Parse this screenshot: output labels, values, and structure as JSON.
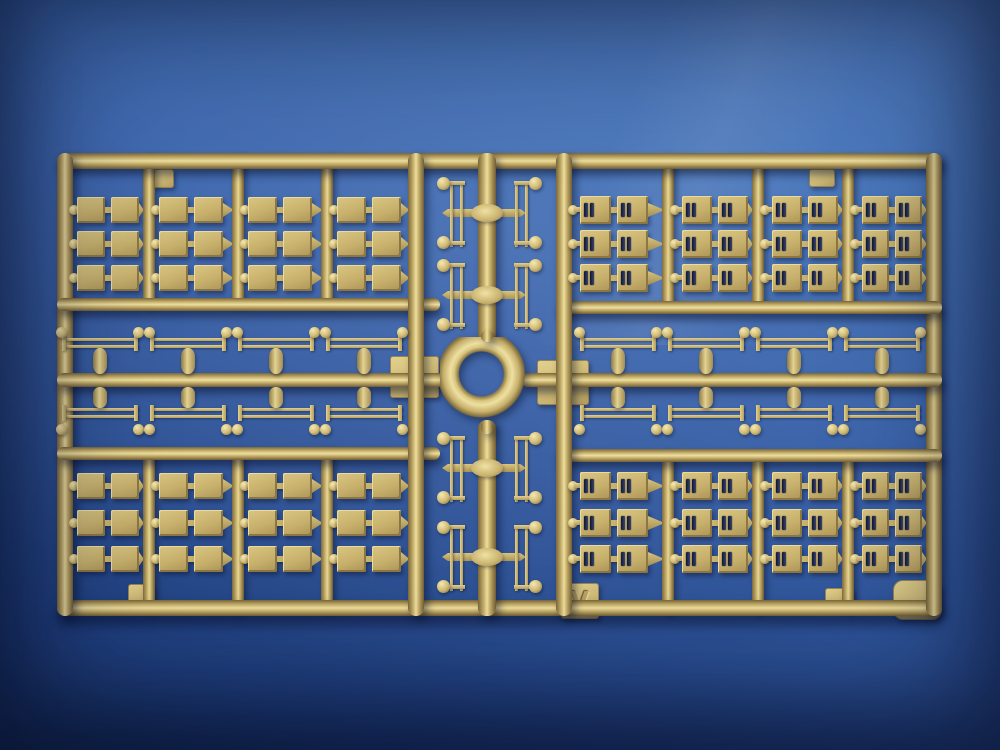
{
  "scene": {
    "type": "photograph",
    "subject": "tan injection-molded plastic model-kit parts sprue lying on a blue surface",
    "sprue_letter": "V",
    "plastic_color_name": "dark yellow / tan",
    "background_color_name": "blue",
    "colors": {
      "plastic_mid": "#c9b26e",
      "plastic_highlight": "#eedfa0",
      "plastic_shadow": "#7a6739",
      "background_top": "#4e7dc3",
      "background_bottom": "#17315f",
      "slot_shadow": "#10172e"
    },
    "contents": {
      "top_left_grid": {
        "rows": 3,
        "cols": 4,
        "unit": "pair of plain rectangular panels"
      },
      "top_right_grid": {
        "rows": 3,
        "cols": 4,
        "unit": "pair of slotted rectangular panels"
      },
      "bottom_left_grid": {
        "rows": 3,
        "cols": 4,
        "unit": "pair of plain rectangular panels"
      },
      "bottom_right_grid": {
        "rows": 3,
        "cols": 4,
        "unit": "pair of slotted rectangular panels"
      },
      "middle_left_axles": {
        "above_runner": 4,
        "below_runner": 4
      },
      "middle_right_axles": {
        "above_runner": 4,
        "below_runner": 4
      },
      "center_ladder_parts": {
        "rows": 4,
        "per_row": 2
      },
      "center_ring": {
        "count": 1
      },
      "molding_tabs": {
        "count": 8
      }
    }
  }
}
